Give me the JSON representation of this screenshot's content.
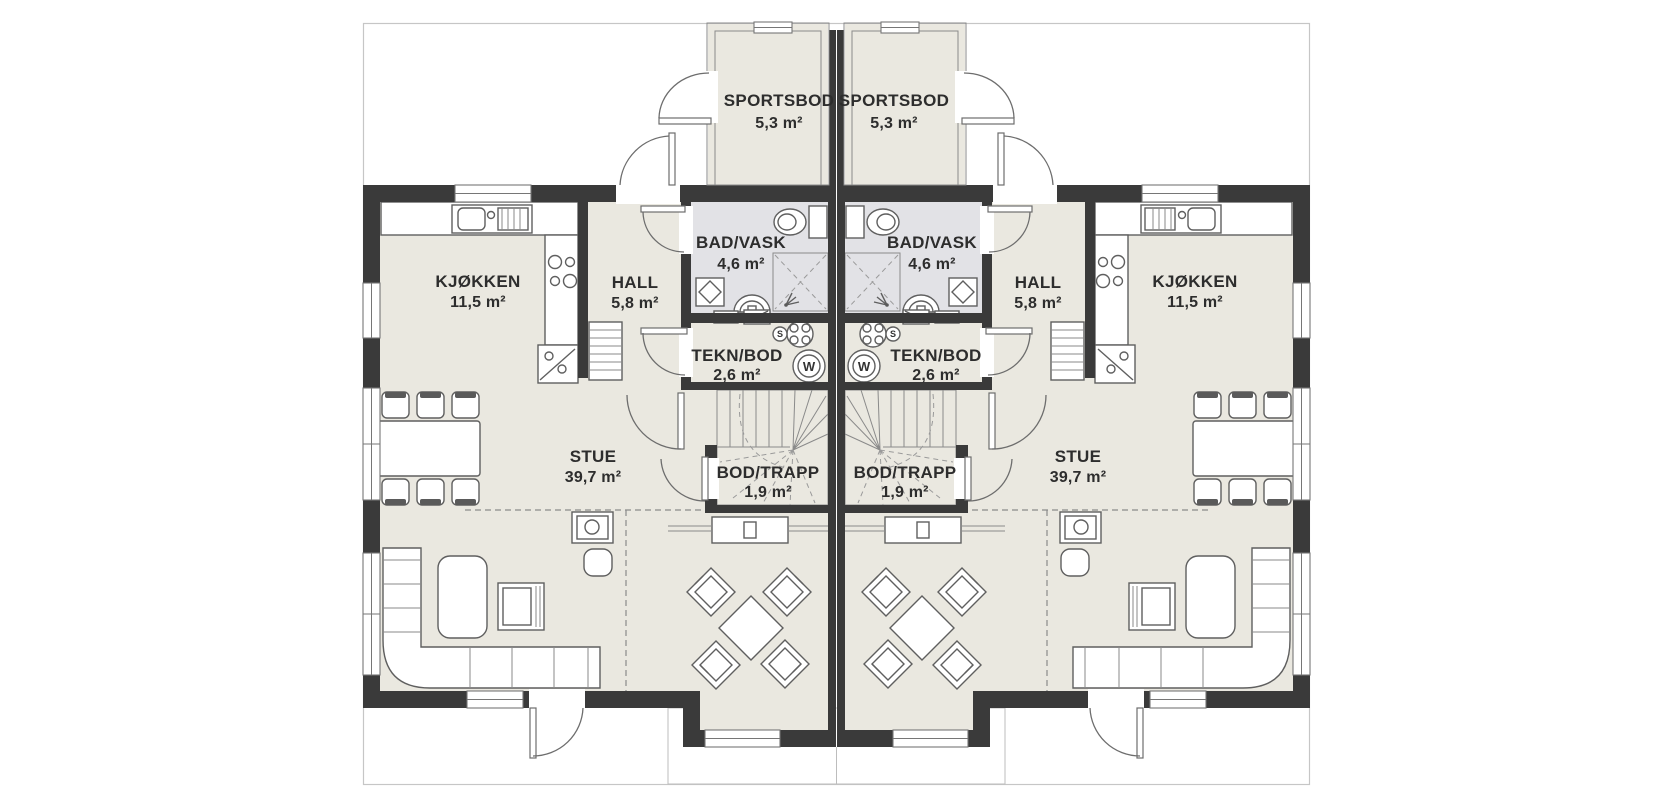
{
  "units": [
    {
      "id": "unit-left",
      "rooms": [
        {
          "name": "SPORTSBOD",
          "area": "5,3 m²"
        },
        {
          "name": "BAD/VASK",
          "area": "4,6 m²"
        },
        {
          "name": "HALL",
          "area": "5,8 m²"
        },
        {
          "name": "KJØKKEN",
          "area": "11,5 m²"
        },
        {
          "name": "TEKN/BOD",
          "area": "2,6 m²"
        },
        {
          "name": "BOD/TRAPP",
          "area": "1,9 m²"
        },
        {
          "name": "STUE",
          "area": "39,7 m²"
        }
      ],
      "appliances": {
        "washing_machine": "W",
        "water_heater": "S"
      }
    },
    {
      "id": "unit-right",
      "rooms": [
        {
          "name": "SPORTSBOD",
          "area": "5,3 m²"
        },
        {
          "name": "BAD/VASK",
          "area": "4,6 m²"
        },
        {
          "name": "HALL",
          "area": "5,8 m²"
        },
        {
          "name": "KJØKKEN",
          "area": "11,5 m²"
        },
        {
          "name": "TEKN/BOD",
          "area": "2,6 m²"
        },
        {
          "name": "BOD/TRAPP",
          "area": "1,9 m²"
        },
        {
          "name": "STUE",
          "area": "39,7 m²"
        }
      ],
      "appliances": {
        "washing_machine": "W",
        "water_heater": "S"
      }
    }
  ],
  "colors": {
    "wall": "#3a3a3a",
    "floor": "#eae8e0",
    "bathroom_floor": "#e2e2e6",
    "outline": "#5f5f5f",
    "frame_line": "#c6c6c6",
    "background": "#ffffff"
  }
}
